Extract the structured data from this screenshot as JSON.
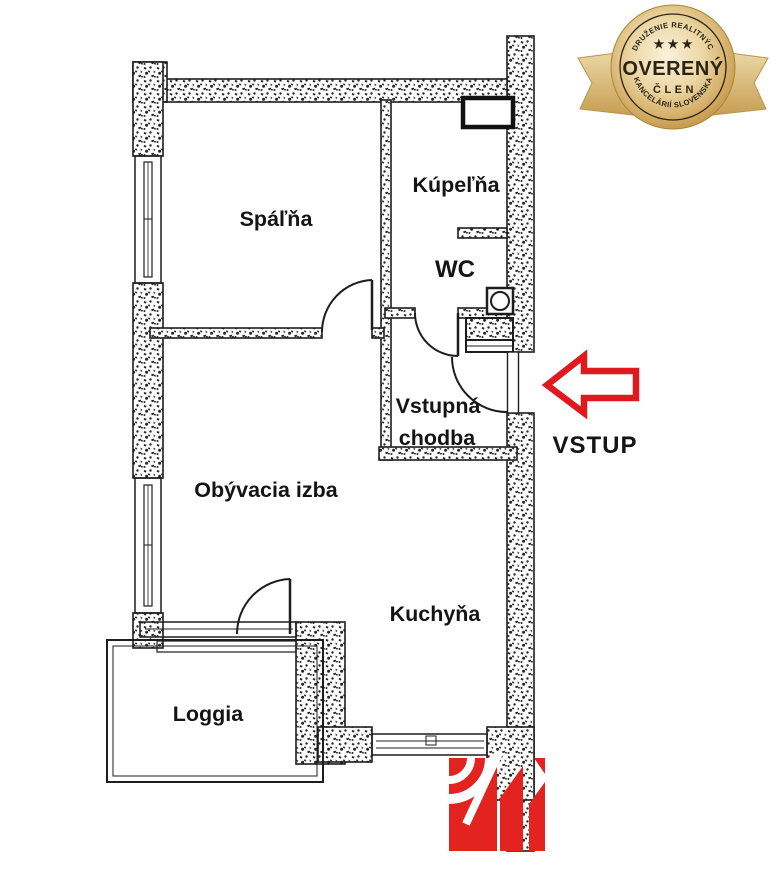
{
  "page": {
    "background_color": "#ffffff"
  },
  "floorplan": {
    "rooms": [
      {
        "name": "spalna",
        "label": "Spáľňa"
      },
      {
        "name": "kupelna",
        "label": "Kúpeľňa"
      },
      {
        "name": "wc",
        "label": "WC"
      },
      {
        "name": "vstupna-chodba",
        "line1": "Vstupná",
        "line2": "chodba"
      },
      {
        "name": "obyvacia-izba",
        "label": "Obývacia izba"
      },
      {
        "name": "kuchyna",
        "label": "Kuchyňa"
      },
      {
        "name": "loggia",
        "label": "Loggia"
      }
    ],
    "entrance_label": "VSTUP",
    "entrance_color": "#e0191f",
    "line_color": "#1d1d1d"
  },
  "badge": {
    "arc_top": "ZDRUŽENIE REALITNÝCH",
    "stars": "★ ★ ★",
    "title": "OVERENÝ",
    "subtitle": "ČLEN",
    "arc_bottom": "KANCELÁRIÍ SLOVENSKA",
    "gold_color": "#d4b36e",
    "text_color": "#2b2416"
  },
  "logo": {
    "color": "#e2231f"
  }
}
